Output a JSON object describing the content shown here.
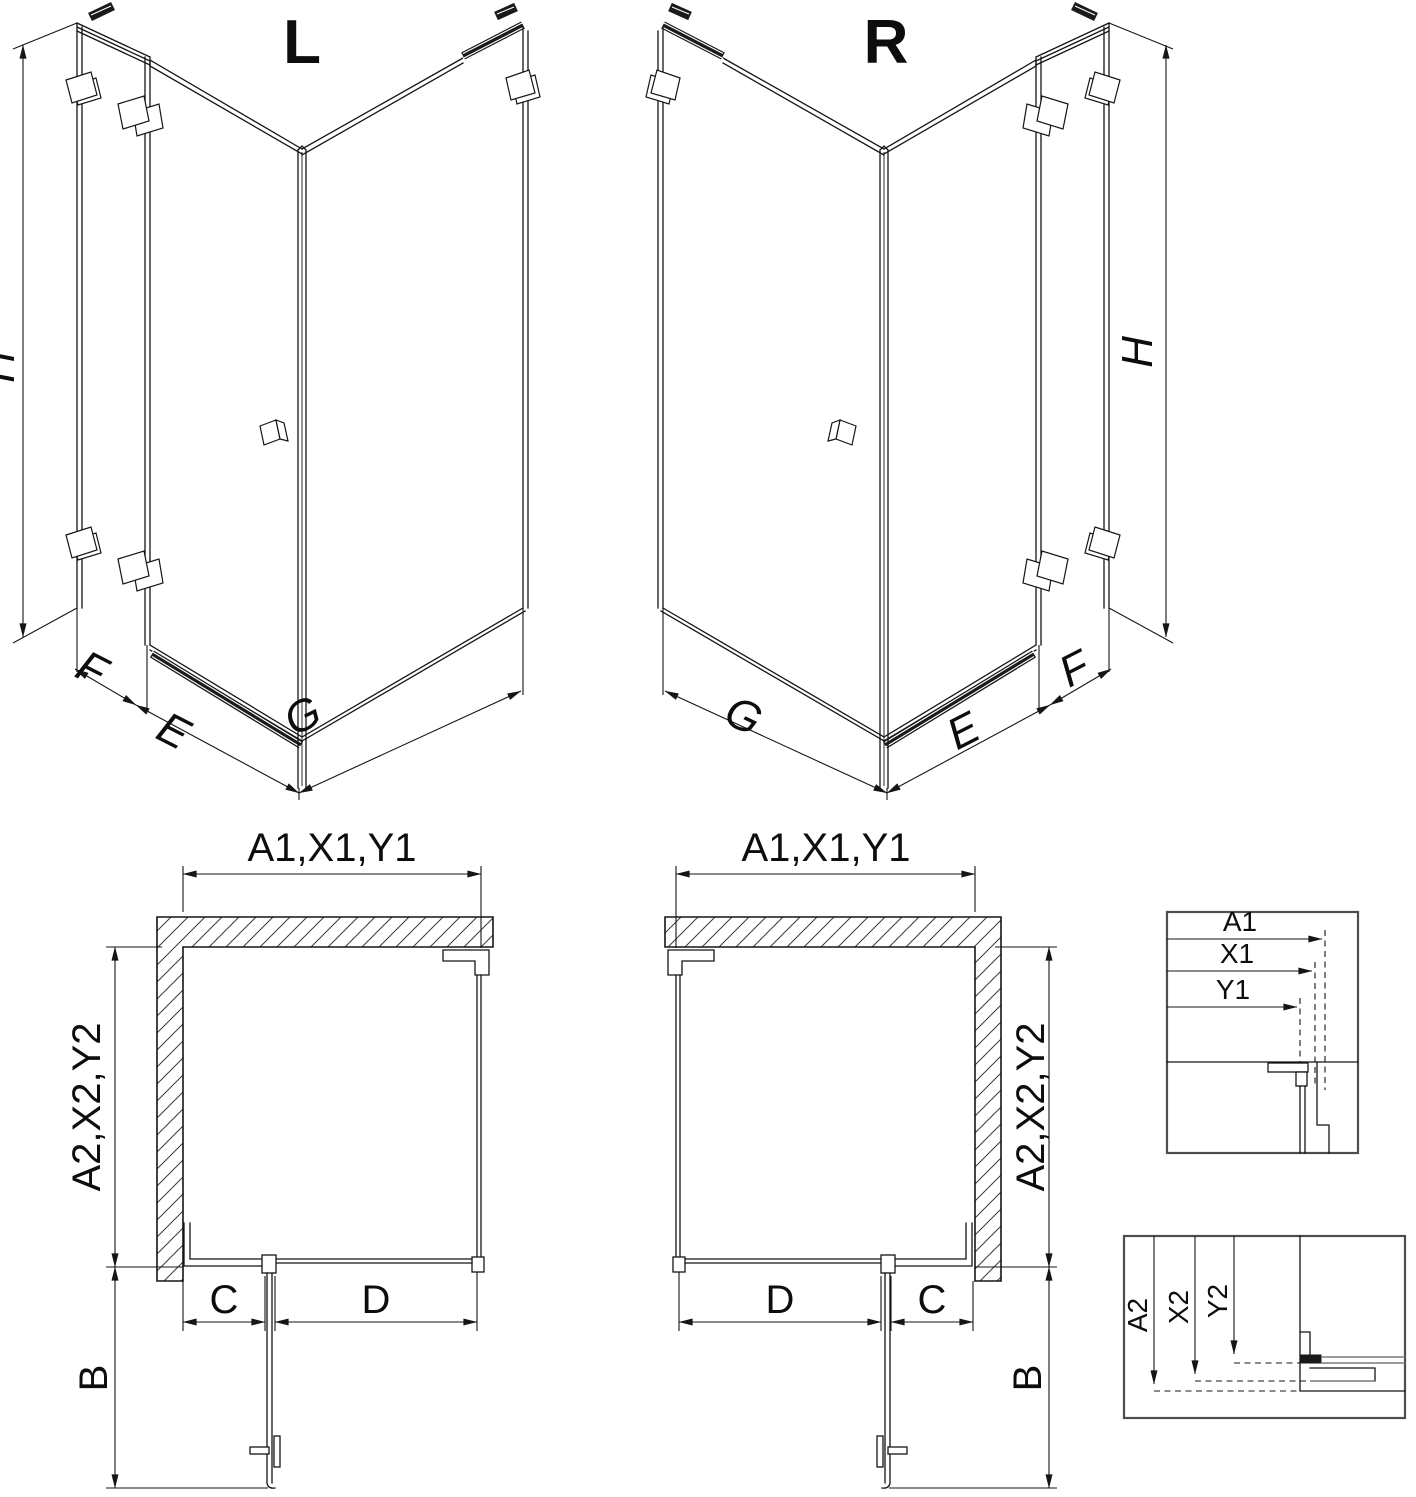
{
  "colors": {
    "line": "#151515",
    "detail_box": "#4d4d4d",
    "profile_gray": "#7a7a7a",
    "background": "#ffffff"
  },
  "iso_left": {
    "label": "L",
    "height": "H",
    "fixed": "F",
    "door": "E",
    "side": "G"
  },
  "iso_right": {
    "label": "R",
    "height": "H",
    "fixed": "F",
    "door": "E",
    "side": "G"
  },
  "plan_left": {
    "front": "A1,X1,Y1",
    "depth": "A2,X2,Y2",
    "swing": "B",
    "fixed": "C",
    "door": "D"
  },
  "plan_right": {
    "front": "A1,X1,Y1",
    "depth": "A2,X2,Y2",
    "swing": "B",
    "fixed": "C",
    "door": "D"
  },
  "detail_front": {
    "a": "A1",
    "x": "X1",
    "y": "Y1"
  },
  "detail_depth": {
    "a": "A2",
    "x": "X2",
    "y": "Y2"
  }
}
